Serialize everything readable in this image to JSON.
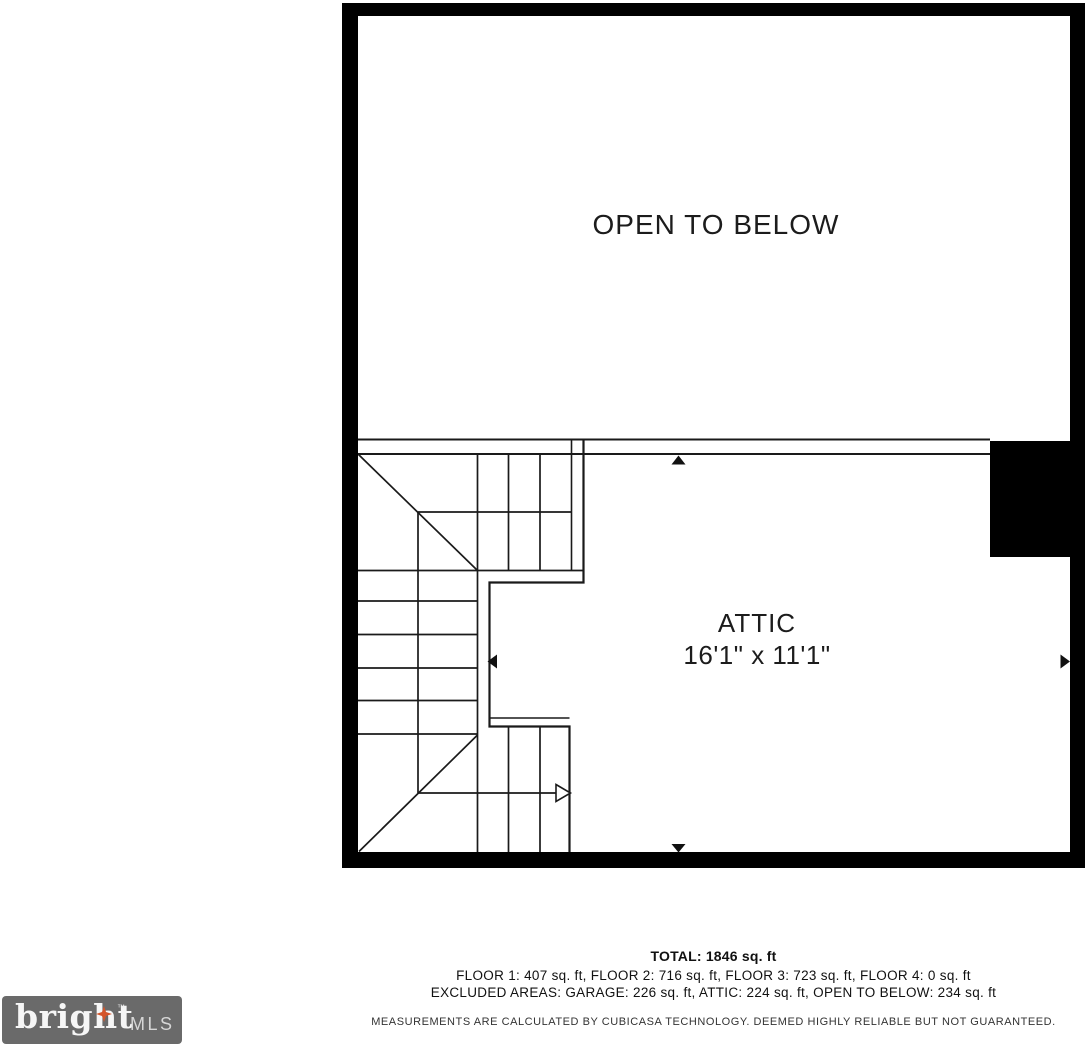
{
  "plan": {
    "open_to_below_label": "OPEN TO BELOW",
    "attic_label": "ATTIC",
    "attic_dimensions": "16'1\" x 11'1\""
  },
  "footer": {
    "total": "TOTAL: 1846 sq. ft",
    "floor_breakdown": "FLOOR 1: 407 sq. ft, FLOOR 2: 716 sq. ft, FLOOR 3: 723 sq. ft, FLOOR 4: 0 sq. ft",
    "excluded_areas": "EXCLUDED AREAS: GARAGE: 226 sq. ft, ATTIC: 224 sq. ft, OPEN TO BELOW: 234 sq. ft",
    "disclaimer": "MEASUREMENTS ARE CALCULATED BY CUBICASA TECHNOLOGY. DEEMED HIGHLY RELIABLE BUT NOT GUARANTEED."
  },
  "logo": {
    "brand": "bright",
    "suffix": "MLS",
    "trademark": "™",
    "background_color": "#6a6a6a",
    "star_color": "#d4552a"
  },
  "colors": {
    "wall": "#000000",
    "line": "#1a1a1a"
  }
}
